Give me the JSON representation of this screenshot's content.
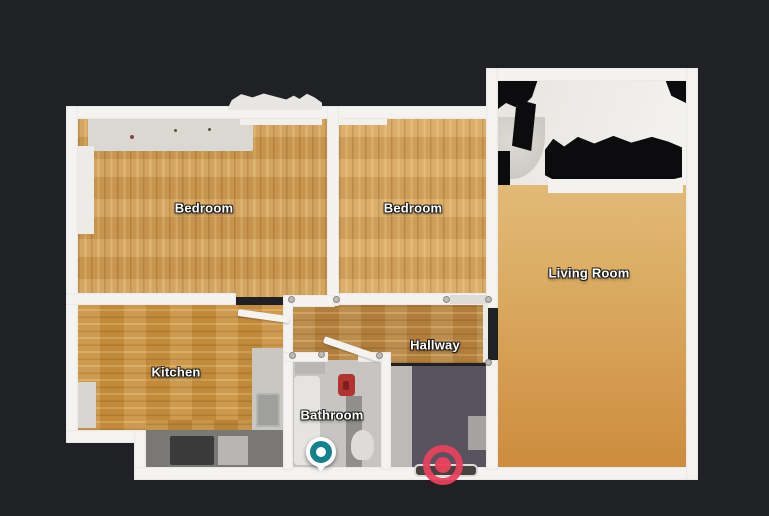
{
  "app": {
    "description": "3D dollhouse floor plan top-down view",
    "background_color": "#202125",
    "wall_color": "#f4f3f1"
  },
  "floorplan": {
    "rooms": [
      {
        "id": "bedroom-1",
        "label": "Bedroom",
        "floor": "light wood, vertical planks"
      },
      {
        "id": "bedroom-2",
        "label": "Bedroom",
        "floor": "light wood, vertical planks"
      },
      {
        "id": "living-room",
        "label": "Living Room",
        "floor": "wood with white bed area and black scan voids"
      },
      {
        "id": "kitchen",
        "label": "Kitchen",
        "floor": "wood with grey counters"
      },
      {
        "id": "hallway",
        "label": "Hallway",
        "floor": "wood and dark slate"
      },
      {
        "id": "bathroom",
        "label": "Bathroom",
        "floor": "grey tile"
      }
    ],
    "markers": [
      {
        "id": "camera-pin",
        "name": "current-position-pin",
        "color": "#15808e",
        "shape": "white circle with teal ring"
      },
      {
        "id": "destination-ring",
        "name": "selected-destination-ring",
        "color": "#e9405d",
        "shape": "red bullseye"
      }
    ],
    "palette": {
      "wood_light": "#d7a75f",
      "wood_mid": "#cf9c54",
      "wood_kitchen": "#c8913f",
      "wood_hallway": "#b5823f",
      "slate_floor": "#57545f",
      "bathroom_tile": "#c7c5c2",
      "scan_void": "#0c0c0e"
    }
  }
}
